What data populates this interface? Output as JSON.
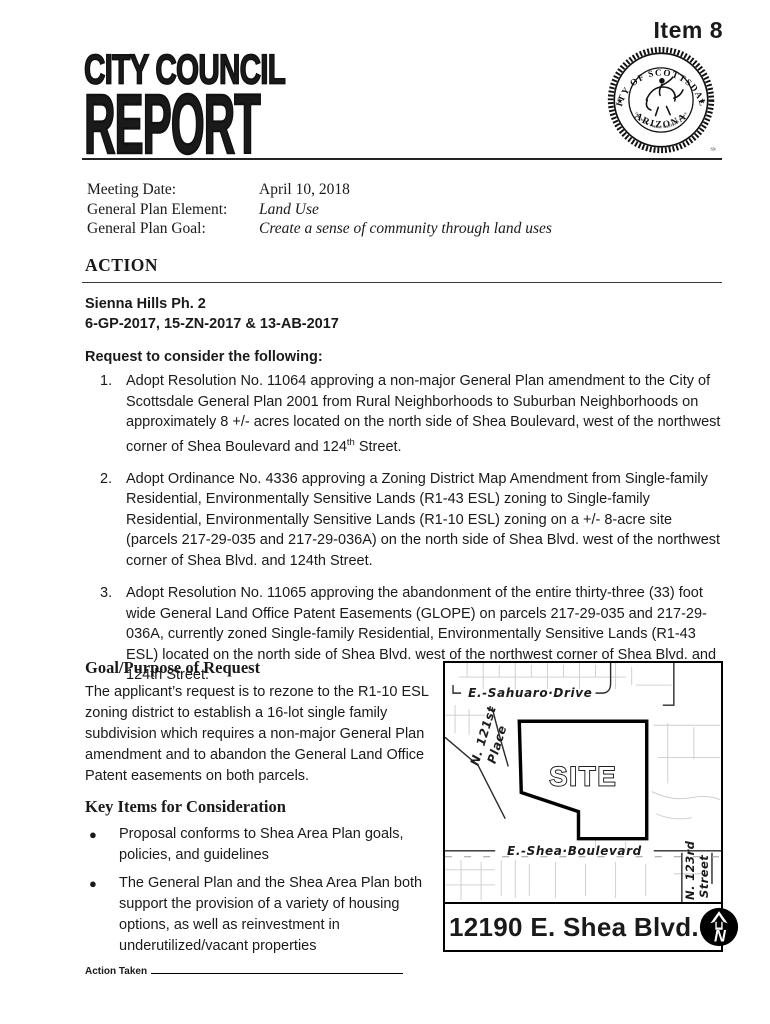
{
  "header": {
    "item_label": "Item 8",
    "title_line1": "CITY COUNCIL",
    "title_line2": "REPORT"
  },
  "seal": {
    "top_text": "CITY OF SCOTTSDALE",
    "bottom_text": "ARIZONA",
    "motto": "THE WEST'S MOST WESTERN TOWN",
    "star": "★",
    "trademark": "SM"
  },
  "meeting_info": {
    "rows": [
      {
        "label": "Meeting Date:",
        "value": "April 10, 2018"
      },
      {
        "label": "General Plan Element:",
        "value": "Land Use"
      },
      {
        "label": "General Plan Goal:",
        "value": "Create a sense of community through land uses"
      }
    ]
  },
  "action": {
    "heading": "ACTION",
    "case_title": "Sienna Hills Ph. 2",
    "case_numbers": "6-GP-2017, 15-ZN-2017 & 13-AB-2017",
    "request_intro": "Request to consider the following:",
    "items": [
      {
        "number": "1.",
        "text": "Adopt Resolution No. 11064 approving a non-major General Plan amendment to the City of Scottsdale General Plan 2001 from Rural Neighborhoods to Suburban Neighborhoods on approximately 8 +/- acres located on the north side of Shea Boulevard, west of the northwest corner of Shea Boulevard and 124",
        "sup": "th",
        "text_after": " Street."
      },
      {
        "number": "2.",
        "text": "Adopt Ordinance No. 4336 approving a Zoning District Map Amendment from Single-family Residential, Environmentally Sensitive Lands (R1-43 ESL) zoning to Single-family Residential, Environmentally Sensitive Lands (R1-10 ESL) zoning on a +/- 8-acre site (parcels 217-29-035 and 217-29-036A) on the north side of Shea Blvd. west of the northwest corner of Shea Blvd. and 124th Street."
      },
      {
        "number": "3.",
        "text": "Adopt Resolution No. 11065 approving the abandonment of the entire thirty-three (33) foot wide General Land Office Patent Easements (GLOPE) on parcels 217-29-035 and 217-29-036A, currently zoned Single-family Residential, Environmentally Sensitive Lands (R1-43 ESL) located on the north side of Shea Blvd. west of the northwest corner of Shea Blvd. and 124th Street."
      }
    ]
  },
  "goal_section": {
    "heading": "Goal/Purpose of Request",
    "body": "The applicant’s request is to rezone to the R1-10 ESL zoning district to establish a 16-lot single family subdivision which requires a non-major General Plan amendment and to abandon the General Land Office Patent easements on both parcels."
  },
  "key_items_section": {
    "heading": "Key Items for Consideration",
    "bullet_char": "●",
    "bullets": [
      "Proposal conforms to Shea Area Plan goals, policies, and guidelines",
      "The General Plan and the Shea Area Plan both support the provision of a variety of housing options, as well as reinvestment in underutilized/vacant properties"
    ]
  },
  "map": {
    "labels": {
      "sahuaro": "E.-Sahuaro·Drive",
      "n121_line1": "N. 121st",
      "n121_line2": "Place",
      "site": "SITE",
      "shea": "E.-Shea·Boulevard",
      "n123_line1": "N. 123rd",
      "n123_line2": "Street"
    },
    "address": "12190 E. Shea Blvd.",
    "north_label": "N"
  },
  "footer": {
    "action_taken_label": "Action Taken"
  }
}
